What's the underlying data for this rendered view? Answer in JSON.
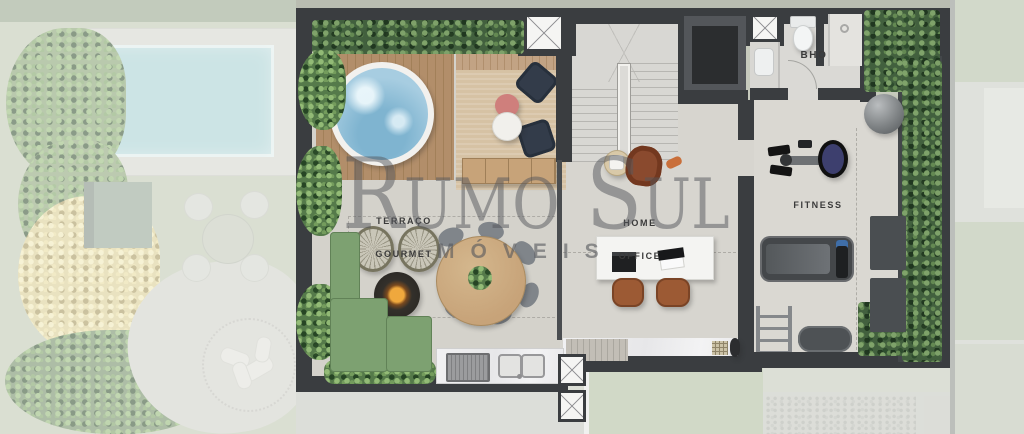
{
  "watermark": {
    "brand": "Rumo Sul",
    "tagline": "MÓVEIS"
  },
  "rooms": {
    "terraco_gourmet": {
      "line1": "TERRAÇO",
      "line2": "GOURMET"
    },
    "home_office": {
      "line1": "HOME",
      "line2": "OFFICE"
    },
    "fitness": {
      "label": "FITNESS"
    },
    "bho": {
      "label": "BHO"
    }
  },
  "palette": {
    "wall": "#3a3d40",
    "floor": "#d6d4ce",
    "hedge": "#42603e",
    "deck": "#b28e6a",
    "water": "#a7cde1",
    "rug": "#d6c2a4",
    "sofa": "#7da171",
    "wood": "#c7a379",
    "fire": "#efa83d",
    "lawn": "#b2bfa0",
    "pool": "#a9d4da",
    "label": "#3a3a3a",
    "mark": "#55575c"
  }
}
